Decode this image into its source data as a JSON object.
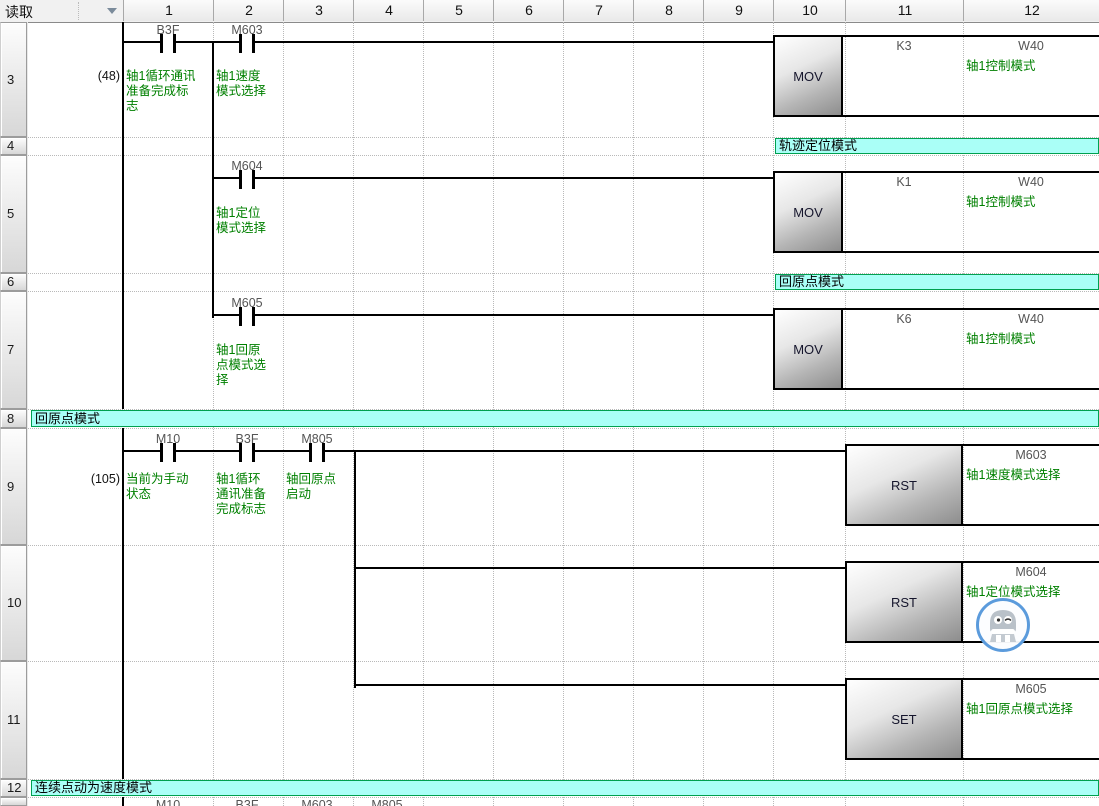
{
  "header": {
    "mode_label": "读取",
    "columns": [
      "1",
      "2",
      "3",
      "4",
      "5",
      "6",
      "7",
      "8",
      "9",
      "10",
      "11",
      "12"
    ]
  },
  "gutter": {
    "rows": [
      {
        "num": "3"
      },
      {
        "num": "4"
      },
      {
        "num": "5"
      },
      {
        "num": "6"
      },
      {
        "num": "7"
      },
      {
        "num": "8"
      },
      {
        "num": "9"
      },
      {
        "num": "10"
      },
      {
        "num": "11"
      },
      {
        "num": "12"
      }
    ]
  },
  "rungs": [
    {
      "step": "(48)",
      "contacts": [
        {
          "label": "B3F",
          "comment": "轴1循环通讯\n准备完成标\n志"
        },
        {
          "label": "M603",
          "comment": "轴1速度\n模式选择"
        }
      ],
      "instruction": {
        "mnemonic": "MOV",
        "source": "K3",
        "dest": "W40",
        "dest_comment": "轴1控制模式"
      }
    },
    {
      "contacts": [
        {
          "label": "M604",
          "comment": "轴1定位\n模式选择"
        }
      ],
      "instruction": {
        "mnemonic": "MOV",
        "source": "K1",
        "dest": "W40",
        "dest_comment": "轴1控制模式"
      }
    },
    {
      "contacts": [
        {
          "label": "M605",
          "comment": "轴1回原\n点模式选\n择"
        }
      ],
      "instruction": {
        "mnemonic": "MOV",
        "source": "K6",
        "dest": "W40",
        "dest_comment": "轴1控制模式"
      }
    },
    {
      "step": "(105)",
      "contacts": [
        {
          "label": "M10",
          "comment": "当前为手动\n状态"
        },
        {
          "label": "B3F",
          "comment": "轴1循环\n通讯准备\n完成标志"
        },
        {
          "label": "M805",
          "comment": "轴回原点\n启动"
        }
      ],
      "instruction": {
        "mnemonic": "RST",
        "dest": "M603",
        "dest_comment": "轴1速度模式选择"
      }
    },
    {
      "instruction": {
        "mnemonic": "RST",
        "dest": "M604",
        "dest_comment": "轴1定位模式选择"
      }
    },
    {
      "instruction": {
        "mnemonic": "SET",
        "dest": "M605",
        "dest_comment": "轴1回原点模式选择"
      }
    }
  ],
  "statements": [
    {
      "text": "轨迹定位模式"
    },
    {
      "text": "回原点模式"
    },
    {
      "text": "回原点模式"
    },
    {
      "text": "连续点动为速度模式"
    }
  ],
  "next_rung_partial": {
    "labels": [
      "M10",
      "B3F",
      "M603",
      "M805"
    ]
  },
  "colors": {
    "statement_bg": "#AAFFF7",
    "statement_border": "#00A050",
    "comment_green": "#008000",
    "device_label_gray": "#555555",
    "assistant_ring_blue": "#5B9BDC"
  }
}
